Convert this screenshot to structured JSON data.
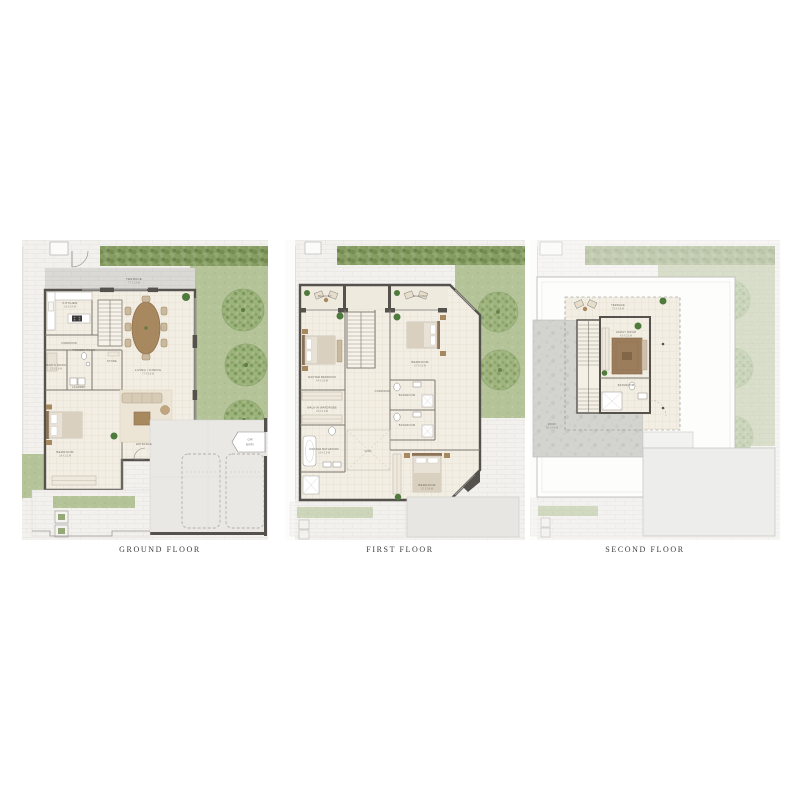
{
  "page": {
    "background": "#ffffff"
  },
  "colors": {
    "wall": "#55524e",
    "interior_floor": "#f2eee3",
    "grass": "#b5c399",
    "hedge": "#879d64",
    "tree": "#9db37c",
    "paving": "#f2f1ee",
    "concrete": "#e9e8e4",
    "roof_grey": "#d3d3d0",
    "wood": "#a8885f",
    "fabric": "#d7cbb6",
    "plant": "#4e7a3c",
    "caption_text": "#3d3d3d"
  },
  "floors": {
    "ground": {
      "caption": "GROUND FLOOR",
      "rooms": {
        "terrace": {
          "label": "TERRACE",
          "dim": "7.7 X 2.0 M"
        },
        "kitchen": {
          "label": "KITCHEN",
          "dim": "3.6 X 3.0 M"
        },
        "living_dining": {
          "label": "LIVING / DINING",
          "dim": "7.7 X 5.5 M"
        },
        "corridor": {
          "label": "CORRIDOR"
        },
        "powder": {
          "label": "POWDER ROOM",
          "dim": "1.9 X 1.4 M"
        },
        "maid": {
          "label": "MAID'S ROOM",
          "dim": "2.3 X 1.8 M"
        },
        "laundry": {
          "label": "LAUNDRY",
          "dim": "2.0 X 1.6 M"
        },
        "store": {
          "label": "STORE",
          "dim": "1.9 X 1.3 M"
        },
        "bedroom": {
          "label": "BEDROOM",
          "dim": "3.6 X 3.2 M"
        },
        "entrance": {
          "label": "ENTRANCE"
        },
        "car_entry": {
          "line1": "CAR",
          "line2": "ENTRY"
        }
      }
    },
    "first": {
      "caption": "FIRST FLOOR",
      "rooms": {
        "balcony_left": {
          "label": "BALCONY",
          "dim": "2.6 X 1.3 M"
        },
        "balcony_right": {
          "label": "BALCONY",
          "dim": "2.6 X 1.3 M"
        },
        "master_bedroom": {
          "label": "MASTER BEDROOM",
          "dim": "4.4 X 3.8 M"
        },
        "bedroom_2": {
          "label": "BEDROOM",
          "dim": "3.7 X 3.3 M"
        },
        "bedroom_3": {
          "label": "BEDROOM",
          "dim": "3.7 X 3.4 M"
        },
        "corridor": {
          "label": "CORRIDOR"
        },
        "wardrobe": {
          "label": "WALK-IN WARDROBE",
          "dim": "2.6 X 1.9 M"
        },
        "master_bath": {
          "label": "MASTER BATHROOM",
          "dim": "2.9 X 1.9 M"
        },
        "bath_1": {
          "label": "BATHROOM",
          "dim": "2.3 X 1.6 M"
        },
        "bath_2": {
          "label": "BATHROOM",
          "dim": "2.3 X 1.6 M"
        },
        "void": {
          "label": "VOID"
        }
      }
    },
    "second": {
      "caption": "SECOND FLOOR",
      "rooms": {
        "terrace": {
          "label": "TERRACE",
          "dim": "7.0 X 4.6 M"
        },
        "family": {
          "label": "FAMILY ROOM",
          "dim": "4.0 X 3.3 M"
        },
        "bathroom": {
          "label": "BATHROOM",
          "dim": "2.3 X 1.6 M"
        },
        "roof": {
          "label": "ROOF",
          "dim": "6.2 X 4.0 M"
        }
      }
    }
  }
}
